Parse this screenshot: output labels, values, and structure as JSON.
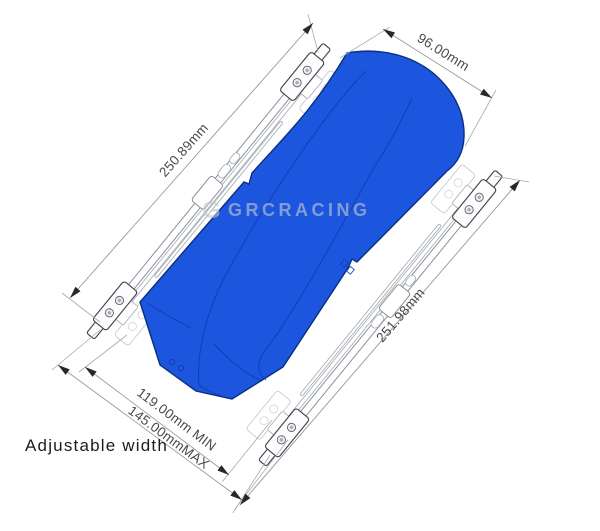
{
  "dimensions": {
    "left_bar": "250.89mm",
    "box_width": "96.00mm",
    "right_bar": "251.98mm",
    "width_min": "119.00mm MIN",
    "width_max": "145.00mmMAX"
  },
  "caption": "Adjustable width",
  "watermark": {
    "logo": "G",
    "text": "GRCRACING"
  },
  "colors": {
    "box_fill": "#1c55de",
    "box_outline": "#0b2f80",
    "panel_line": "#0f3cae"
  }
}
